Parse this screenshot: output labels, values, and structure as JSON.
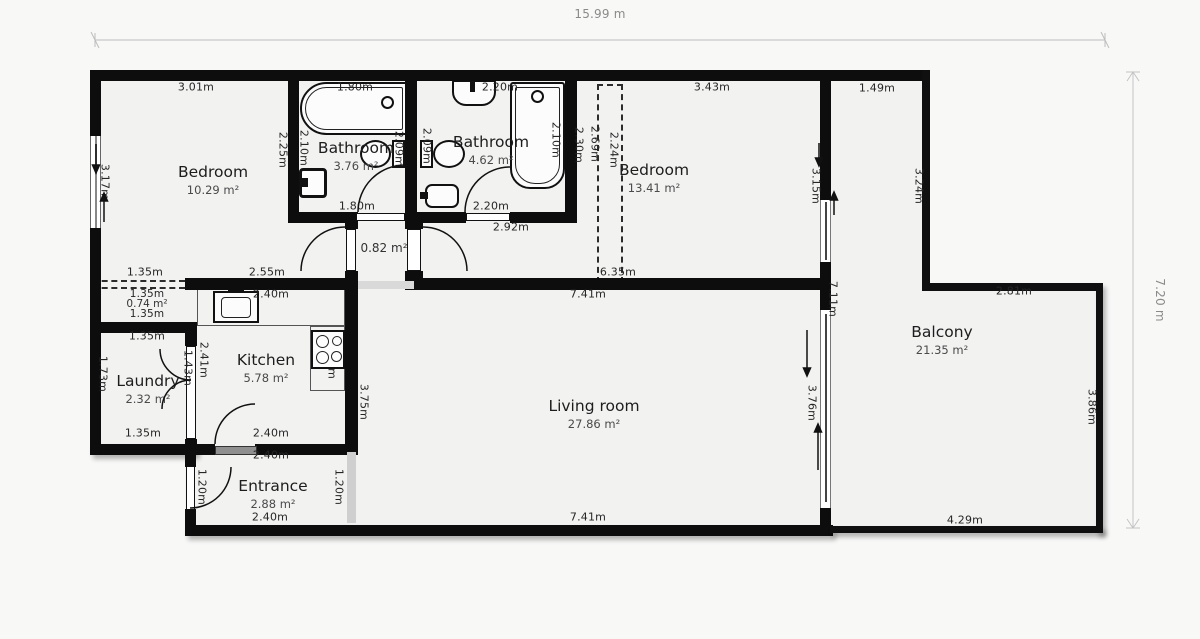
{
  "title": "Apartment floor plan",
  "overall": {
    "width_label": "15.99 m",
    "height_label": "7.20 m"
  },
  "rooms": [
    {
      "name": "Bedroom",
      "area": "10.29 m²"
    },
    {
      "name": "Bathroom",
      "area": "3.76 m²"
    },
    {
      "name": "Bathroom",
      "area": "4.62 m²"
    },
    {
      "name": "Bedroom",
      "area": "13.41 m²"
    },
    {
      "name": "Balcony",
      "area": "21.35 m²"
    },
    {
      "name": "Kitchen",
      "area": "5.78 m²"
    },
    {
      "name": "Laundry",
      "area": "2.32 m²"
    },
    {
      "name": "Living room",
      "area": "27.86 m²"
    },
    {
      "name": "Entrance",
      "area": "2.88 m²"
    },
    {
      "name": "Hallway",
      "area": "0.82 m²"
    },
    {
      "name": "Closet",
      "area": "0.74 m²"
    }
  ],
  "dims": [
    {
      "t": "3.01m"
    },
    {
      "t": "1.80m"
    },
    {
      "t": "2.20m"
    },
    {
      "t": "3.43m"
    },
    {
      "t": "1.49m"
    },
    {
      "t": "2.25m"
    },
    {
      "t": "2.10m"
    },
    {
      "t": "2.09m"
    },
    {
      "t": "2.09m"
    },
    {
      "t": "2.10m"
    },
    {
      "t": "2.30m"
    },
    {
      "t": "2.69m"
    },
    {
      "t": "2.24m"
    },
    {
      "t": "3.17m"
    },
    {
      "t": "3.15m"
    },
    {
      "t": "3.24m"
    },
    {
      "t": "1.80m"
    },
    {
      "t": "2.20m"
    },
    {
      "t": "2.92m"
    },
    {
      "t": "1.35m"
    },
    {
      "t": "2.55m"
    },
    {
      "t": "6.35m"
    },
    {
      "t": "7.41m"
    },
    {
      "t": "7.11m"
    },
    {
      "t": "2.81m"
    },
    {
      "t": "1.35m"
    },
    {
      "t": "1.35m"
    },
    {
      "t": "1.35m"
    },
    {
      "t": "2.40m"
    },
    {
      "t": "2.41m"
    },
    {
      "t": "1.43m"
    },
    {
      "t": "1.73m"
    },
    {
      "t": "2.40m"
    },
    {
      "t": "3.75m"
    },
    {
      "t": "3.76m"
    },
    {
      "t": "3.86m"
    },
    {
      "t": "1.35m"
    },
    {
      "t": "2.40m"
    },
    {
      "t": "2.40m"
    },
    {
      "t": "1.20m"
    },
    {
      "t": "1.20m"
    },
    {
      "t": "2.40m"
    },
    {
      "t": "7.41m"
    },
    {
      "t": "4.29m"
    },
    {
      "t": "15.99 m"
    },
    {
      "t": "7.20 m"
    }
  ],
  "colors": {
    "wall": "#0d0d0d",
    "floor": "#f2f2f1",
    "dim_text": "#262626",
    "overall_dim_text": "#8a8a8a"
  }
}
